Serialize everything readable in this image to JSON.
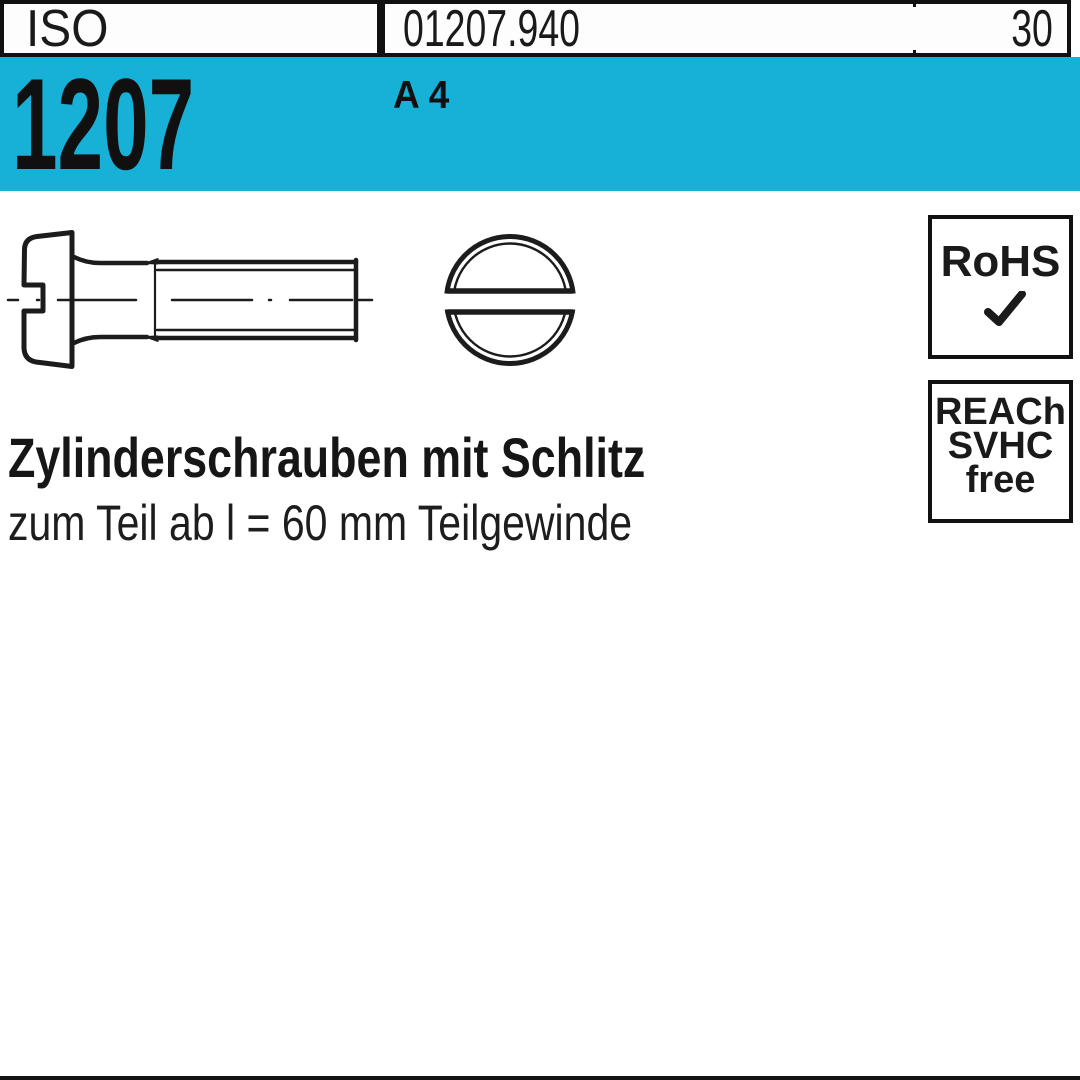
{
  "page": {
    "background": "#ffffff",
    "accent_cyan": "#17b1d8",
    "ink": "#161616"
  },
  "header": {
    "iso_label": "ISO",
    "article_number": "01207.940",
    "page_number": "30",
    "standard_number": "1207",
    "material": "A 4"
  },
  "badges": {
    "rohs_label": "RoHS",
    "rohs_check_icon": "checkmark",
    "reach_line1": "REACh",
    "reach_line2": "SVHC",
    "reach_line3": "free"
  },
  "product": {
    "title": "Zylinderschrauben mit Schlitz",
    "subtitle": "zum Teil ab l = 60 mm Teilgewinde"
  },
  "drawing": {
    "side_view_icon": "screw-side-view",
    "top_view_icon": "screw-top-view"
  }
}
